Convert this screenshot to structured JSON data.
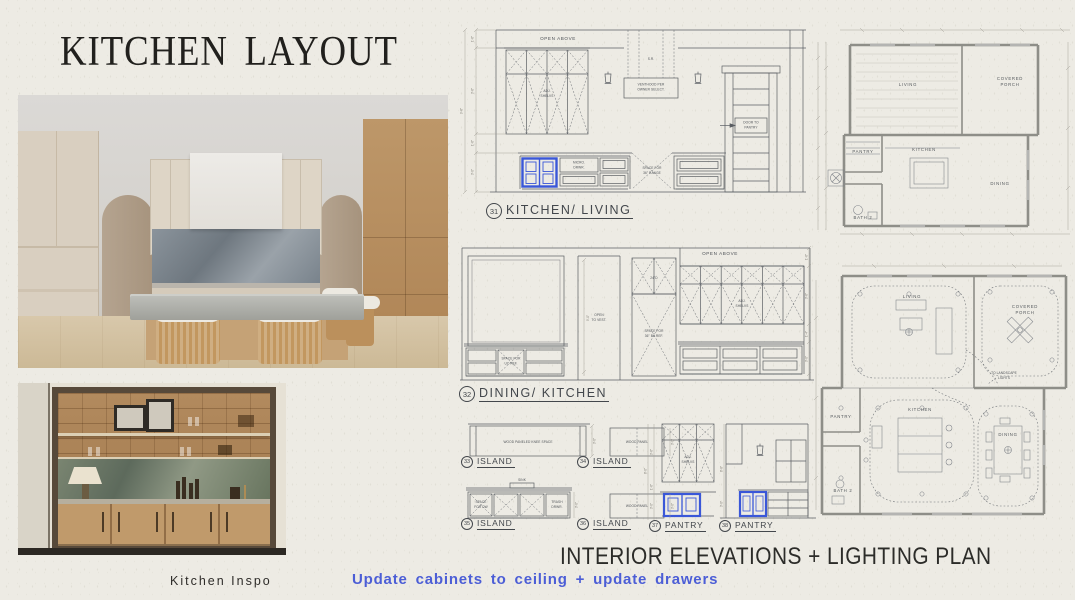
{
  "slide": {
    "title": "KITCHEN LAYOUT",
    "footer_heading": "INTERIOR ELEVATIONS + LIGHTING PLAN",
    "note": "Update cabinets to ceiling + update drawers",
    "photo_caption": "Kitchen Inspo"
  },
  "colors": {
    "paper": "#EDEBE4",
    "drawing_ink": "#5A5E63",
    "wall_gray": "#8E8E88",
    "highlight_blue": "#3A57D8",
    "note_blue": "#4C5ED6"
  },
  "elev31": {
    "number": "31",
    "label": "KITCHEN/ LIVING",
    "open_above": "OPEN ABOVE",
    "adj_1": "ADJ.",
    "adj_2": "SHELVS",
    "sr": "S.R.",
    "venthood_1": "VENTHOOD PER",
    "venthood_2": "OWNER SELECT.",
    "door_1": "DOOR TO",
    "door_2": "PANTRY",
    "micro_1": "MICRO.",
    "micro_2": "DRWR.",
    "range_1": "SPACE FOR",
    "range_2": "36\" RANGE",
    "dims": [
      "1'-6\"",
      "3'-6\"",
      "9'-6\"",
      "1'-6\"",
      "3'-0\""
    ]
  },
  "elev32": {
    "number": "32",
    "label": "DINING/ KITCHEN",
    "open_above": "OPEN ABOVE",
    "open_vest_1": "OPEN",
    "open_vest_2": "TO VEST.",
    "ref_1": "SPACE FOR",
    "ref_2": "36\" BI/ REF.",
    "adj_1": "ADJ.",
    "adj_2": "SHELVS",
    "ucref_1": "SPACE FOR",
    "ucref_2": "UC REF.",
    "depth": "24\"D",
    "vest_height": "9'-0\"",
    "dims": [
      "1'-6\"",
      "3'-6\"",
      "1'-4\"",
      "3'-0\""
    ]
  },
  "islands": [
    {
      "number": "33",
      "label": "ISLAND",
      "note": "WOOD PANELED KNEE SPACE",
      "dim": "3'-0\""
    },
    {
      "number": "34",
      "label": "ISLAND",
      "note": "WOOD PANEL",
      "dim": "3'-0\""
    },
    {
      "number": "35",
      "label": "ISLAND",
      "dw_1": "SPACE",
      "dw_2": "FOR DW",
      "sink": "SINK",
      "trash_1": "TRASH",
      "trash_2": "DRWR.",
      "dim": "3'-0\""
    },
    {
      "number": "36",
      "label": "ISLAND",
      "note": "WOOD PANEL",
      "dim": "3'-0\""
    }
  ],
  "pantries": [
    {
      "number": "37",
      "label": "PANTRY",
      "adj_1": "ADJ.",
      "adj_2": "SHELVS",
      "dims": [
        "3'-6\"",
        "1'-6\"",
        "3'-0\"",
        "8'-0\""
      ]
    },
    {
      "number": "38",
      "label": "PANTRY",
      "dims": [
        "8'-0\"",
        "3'-0\""
      ]
    }
  ],
  "plan_top": {
    "rooms": {
      "living": "LIVING",
      "porch_1": "COVERED",
      "porch_2": "PORCH",
      "pantry": "PANTRY",
      "kitchen": "KITCHEN",
      "dining": "DINING",
      "bath": "BATH 2"
    }
  },
  "plan_bottom": {
    "rooms": {
      "living": "LIVING",
      "porch_1": "COVERED",
      "porch_2": "PORCH",
      "pantry": "PANTRY",
      "kitchen": "KITCHEN",
      "dining": "DINING",
      "bath": "BATH 2"
    },
    "landscape_1": "TO LANDSCAPE",
    "landscape_2": "LIGHTS"
  }
}
